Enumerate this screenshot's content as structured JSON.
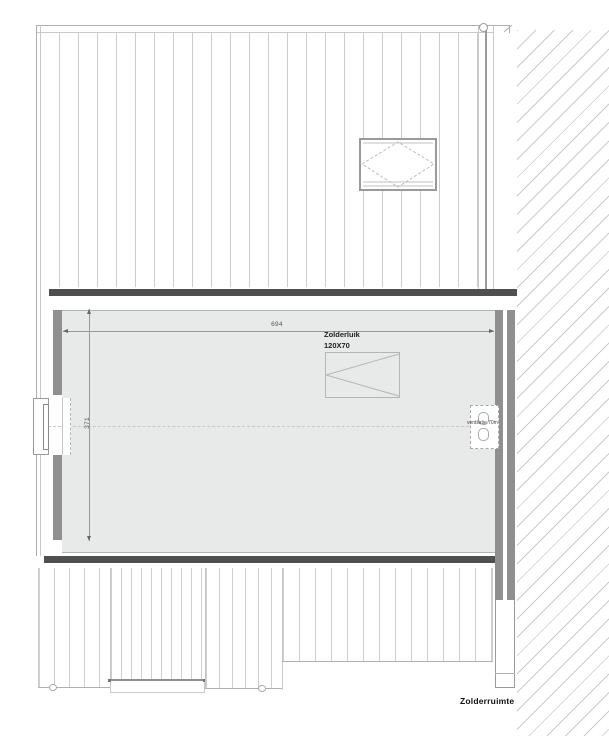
{
  "plan": {
    "room_label": "Zolderruimte",
    "attic_hatch": {
      "name": "Zolderluik",
      "size": "120X70"
    },
    "ventilation": {
      "label": "ventilatie 70m"
    },
    "dimensions": {
      "width": "694",
      "height": "371"
    }
  },
  "colors": {
    "wall_dark": "#4f4f4f",
    "wall_gray": "#8f8f8f",
    "room_fill": "#e8eaea",
    "line_light": "#cccccc",
    "hatch_line": "#cbcbcb",
    "dim_line": "#999999",
    "text_dark": "#222222"
  }
}
